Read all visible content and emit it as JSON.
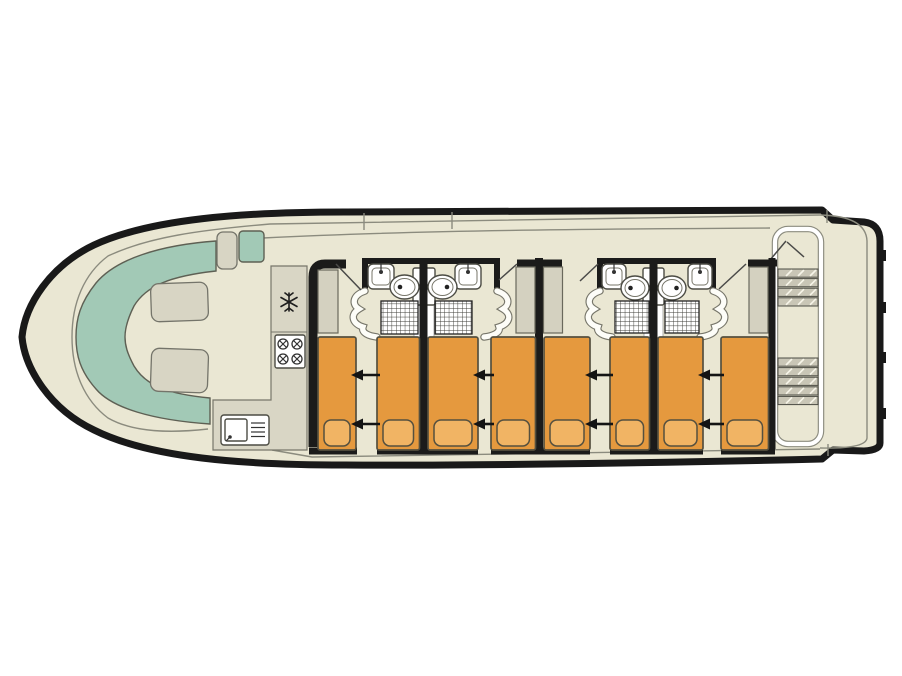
{
  "diagram": {
    "type": "boat-deck-plan",
    "view": "top-down-floor-plan",
    "orientation": "bow-left-stern-right",
    "sections": [
      "bow-lounge",
      "galley",
      "sleeping-cabins",
      "stern-deck"
    ]
  },
  "palette": {
    "background": "#ffffff",
    "deck_cream": "#eae7d3",
    "hull_black": "#191919",
    "bench_teal": "#a2c9b6",
    "cushion_beige": "#d8d5c4",
    "counter_grey": "#d9d6c5",
    "wardrobe_grey": "#d4d1c0",
    "bed_orange": "#e5993e",
    "pillow_orange": "#f1b464",
    "fixture_white": "#ffffff",
    "detail_line_grey": "#8b8b7e"
  },
  "bow_lounge": {
    "bench": "u-shaped-bench",
    "cushions": 2,
    "helm_seats": 2
  },
  "galley": {
    "counter_shape": "L",
    "appliances": [
      "fridge-with-snowflake-icon",
      "four-burner-hob",
      "sink-with-drainer"
    ],
    "hob_burners": 4
  },
  "cabins": [
    {
      "name": "cabin-1",
      "beds": 2,
      "slide_arrows": 2,
      "wardrobes": 1,
      "ensuite": [
        "washbasin",
        "toilet",
        "shower"
      ]
    },
    {
      "name": "cabin-2",
      "beds": 2,
      "slide_arrows": 2,
      "wardrobes": 1,
      "ensuite": [
        "washbasin",
        "toilet",
        "shower"
      ]
    },
    {
      "name": "cabin-3",
      "beds": 2,
      "slide_arrows": 2,
      "wardrobes": 1,
      "ensuite": [
        "washbasin",
        "toilet",
        "shower"
      ]
    },
    {
      "name": "cabin-4",
      "beds": 2,
      "slide_arrows": 2,
      "wardrobes": 1,
      "ensuite": [
        "washbasin",
        "toilet",
        "shower"
      ]
    }
  ],
  "totals": {
    "beds": 8,
    "bathroom_modules": 2,
    "washbasins": 4,
    "toilets": 4,
    "showers": 4,
    "wardrobes": 4
  },
  "stern_deck": {
    "stair_flights": 2,
    "walkway_border": 1,
    "door_leaves": 2
  }
}
